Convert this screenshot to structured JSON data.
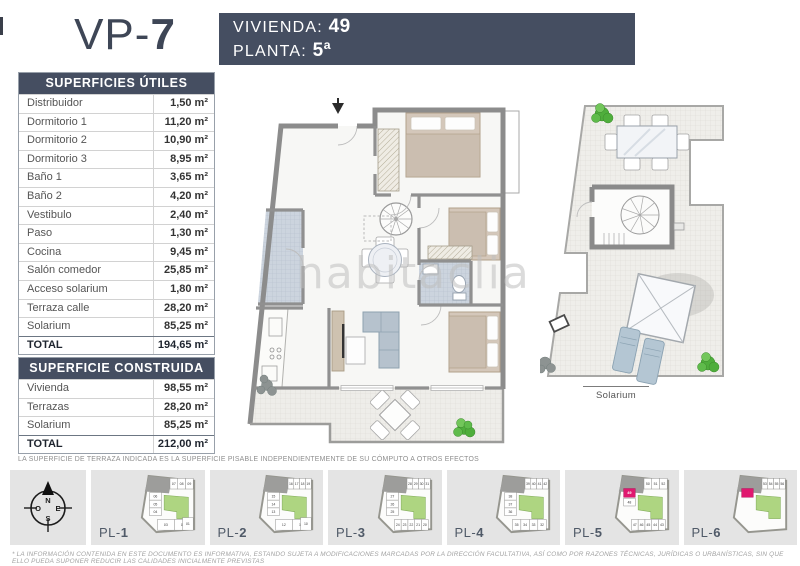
{
  "page": {
    "title_prefix": "VP-",
    "title_number": "7",
    "watermark": "habitaclia"
  },
  "header": {
    "vivienda_label": "VIVIENDA:",
    "vivienda_value": "49",
    "planta_label": "PLANTA:",
    "planta_value": "5ª"
  },
  "tables": {
    "utiles": {
      "title": "SUPERFICIES ÚTILES",
      "rows": [
        {
          "label": "Distribuidor",
          "value": "1,50 m²"
        },
        {
          "label": "Dormitorio 1",
          "value": "11,20 m²"
        },
        {
          "label": "Dormitorio 2",
          "value": "10,90 m²"
        },
        {
          "label": "Dormitorio 3",
          "value": "8,95 m²"
        },
        {
          "label": "Baño 1",
          "value": "3,65 m²"
        },
        {
          "label": "Baño 2",
          "value": "4,20 m²"
        },
        {
          "label": "Vestibulo",
          "value": "2,40 m²"
        },
        {
          "label": "Paso",
          "value": "1,30 m²"
        },
        {
          "label": "Cocina",
          "value": "9,45 m²"
        },
        {
          "label": "Salón comedor",
          "value": "25,85 m²"
        },
        {
          "label": "Acceso solarium",
          "value": "1,80 m²"
        },
        {
          "label": "Terraza calle",
          "value": "28,20 m²"
        },
        {
          "label": "Solarium",
          "value": "85,25 m²"
        }
      ],
      "total": {
        "label": "TOTAL",
        "value": "194,65 m²"
      }
    },
    "construida": {
      "title": "SUPERFICIE CONSTRUIDA",
      "rows": [
        {
          "label": "Vivienda",
          "value": "98,55 m²"
        },
        {
          "label": "Terrazas",
          "value": "28,20 m²"
        },
        {
          "label": "Solarium",
          "value": "85,25 m²"
        }
      ],
      "total": {
        "label": "TOTAL",
        "value": "212,00 m²"
      }
    }
  },
  "plans": {
    "solarium_label": "Solarium"
  },
  "compass": {
    "n": "N",
    "e": "E",
    "s": "S",
    "o": "O"
  },
  "thumbnails": {
    "label_prefix": "PL-",
    "items": [
      {
        "number": "1",
        "top": [
          "07",
          "08",
          "09"
        ],
        "left": [
          "06",
          "05",
          "04"
        ],
        "bottom": [
          "03",
          "02"
        ],
        "right": [
          "01"
        ],
        "highlight": null
      },
      {
        "number": "2",
        "top": [
          "16",
          "17",
          "18",
          "19"
        ],
        "left": [
          "15",
          "14",
          "13"
        ],
        "bottom": [
          "12",
          "11"
        ],
        "right": [
          "10"
        ],
        "highlight": null
      },
      {
        "number": "3",
        "top": [
          "28",
          "29",
          "30",
          "31"
        ],
        "left": [
          "27",
          "26",
          "25"
        ],
        "bottom": [
          "24",
          "23",
          "22",
          "21",
          "20"
        ],
        "right": [],
        "highlight": null
      },
      {
        "number": "4",
        "top": [
          "39",
          "40",
          "41",
          "42"
        ],
        "left": [
          "38",
          "37",
          "36"
        ],
        "bottom": [
          "35",
          "34",
          "33",
          "32"
        ],
        "right": [],
        "highlight": null
      },
      {
        "number": "5",
        "top": [
          "50",
          "51",
          "52"
        ],
        "left": [
          "48"
        ],
        "bottom": [
          "47",
          "46",
          "45",
          "44",
          "43"
        ],
        "right": [],
        "highlight": "49"
      },
      {
        "number": "6",
        "top": [
          "53",
          "54",
          "55",
          "56"
        ],
        "left": [],
        "bottom": [],
        "right": [],
        "highlight": ""
      }
    ]
  },
  "notes": {
    "terrace_note": "LA SUPERFICIE DE TERRAZA INDICADA ES LA SUPERFICIE PISABLE INDEPENDIENTEMENTE DE SU CÓMPUTO A OTROS EFECTOS",
    "disclaimer": "* LA INFORMACIÓN CONTENIDA EN ESTE DOCUMENTO ES INFORMATIVA, ESTANDO SUJETA A MODIFICACIONES MARCADAS POR LA DIRECCIÓN FACULTATIVA, ASÍ COMO POR RAZONES TÉCNICAS, JURÍDICAS O URBANÍSTICAS, SIN QUE ELLO PUEDA SUPONER REDUCIR LAS CALIDADES INICIALMENTE PREVISTAS"
  },
  "colors": {
    "accent_navy": "#454e61",
    "highlight_pink": "#e0186f",
    "plan_green": "#aed581",
    "thumb_bg": "#e4e4e4"
  }
}
